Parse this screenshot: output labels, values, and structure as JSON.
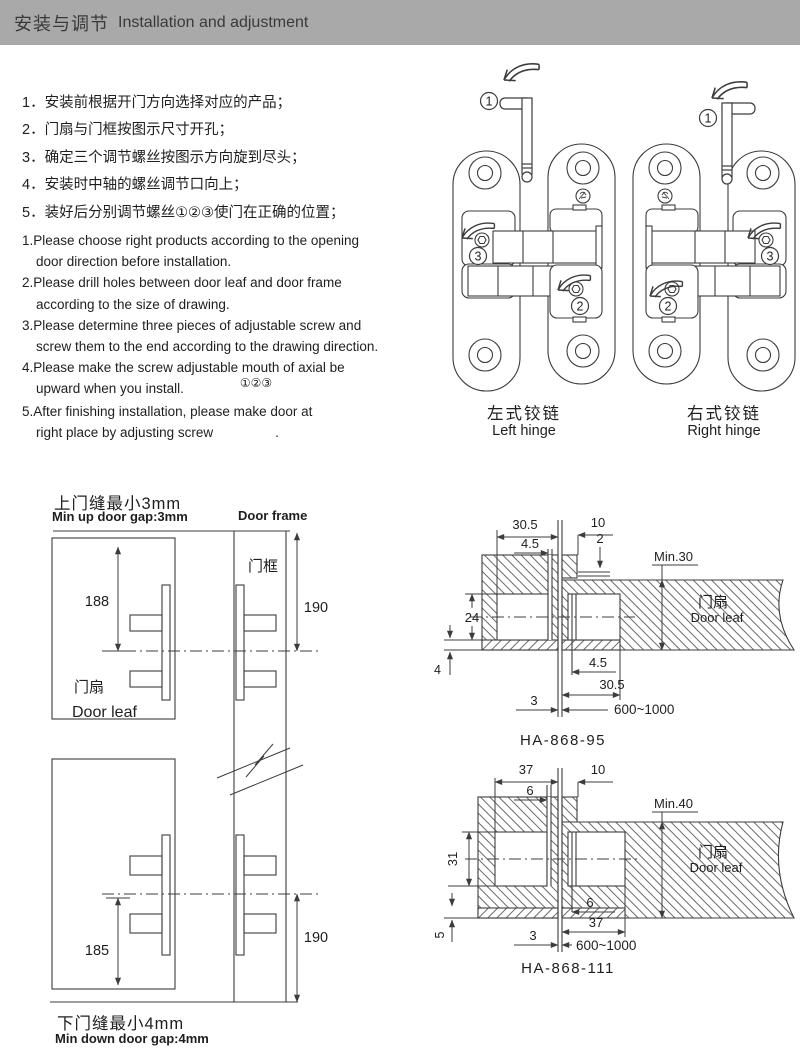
{
  "header": {
    "title_zh": "安装与调节",
    "title_en": "Installation and adjustment",
    "bg_color": "#a9a9a9"
  },
  "instructions_zh": [
    "1．安装前根据开门方向选择对应的产品；",
    "2．门扇与门框按图示尺寸开孔；",
    "3．确定三个调节螺丝按图示方向旋到尽头；",
    "4．安装时中轴的螺丝调节口向上；",
    "5．装好后分别调节螺丝①②③使门在正确的位置；"
  ],
  "instructions_en": {
    "items": [
      {
        "line1": "1.Please choose right products according to the opening",
        "line2": "door direction before installation."
      },
      {
        "line1": "2.Please drill holes between door leaf and door frame",
        "line2": "according  to the size of drawing."
      },
      {
        "line1": "3.Please determine three pieces of adjustable screw and",
        "line2": "screw them to the end according to the drawing direction."
      },
      {
        "line1": "4.Please make the screw adjustable mouth of axial be",
        "line2": "upward when you install."
      },
      {
        "line1": "5.After finishing installation, please make door at",
        "line2": "right place by adjusting screw"
      }
    ],
    "item4_callouts": "①②③",
    "item5_period": "."
  },
  "hinge_figures": {
    "callout_1": "1",
    "callout_2": "2",
    "callout_3": "3",
    "left": {
      "label_zh": "左式铰链",
      "label_en": "Left hinge"
    },
    "right": {
      "label_zh": "右式铰链",
      "label_en": "Right hinge"
    }
  },
  "gap_diagram": {
    "title_top_zh": "上门缝最小3mm",
    "title_top_en": "Min up door gap:3mm",
    "door_frame_en": "Door frame",
    "door_frame_zh": "门框",
    "door_leaf_zh": "门扇",
    "door_leaf_en": "Door leaf",
    "dim_leaf_upper": "188",
    "dim_frame_upper": "190",
    "dim_leaf_lower": "185",
    "dim_frame_lower": "190",
    "title_bottom_zh": "下门缝最小4mm",
    "title_bottom_en": "Min down door gap:4mm"
  },
  "section_95": {
    "caption": "HA-868-95",
    "door_leaf_zh": "门扇",
    "door_leaf_en": "Door leaf",
    "dims": {
      "top_width": "30.5",
      "top_offset": "4.5",
      "notch_width": "10",
      "notch_depth": "2",
      "min_thickness": "Min.30",
      "cavity_height": "24",
      "bottom_margin": "4",
      "bottom_offset": "4.5",
      "bottom_width": "30.5",
      "gap": "3",
      "door_width_range": "600~1000"
    }
  },
  "section_111": {
    "caption": "HA-868-111",
    "door_leaf_zh": "门扇",
    "door_leaf_en": "Door leaf",
    "dims": {
      "top_width": "37",
      "top_offset": "6",
      "notch_width": "10",
      "min_thickness": "Min.40",
      "cavity_height": "31",
      "bottom_margin": "5",
      "bottom_offset": "6",
      "bottom_width": "37",
      "gap": "3",
      "door_width_range": "600~1000"
    }
  }
}
